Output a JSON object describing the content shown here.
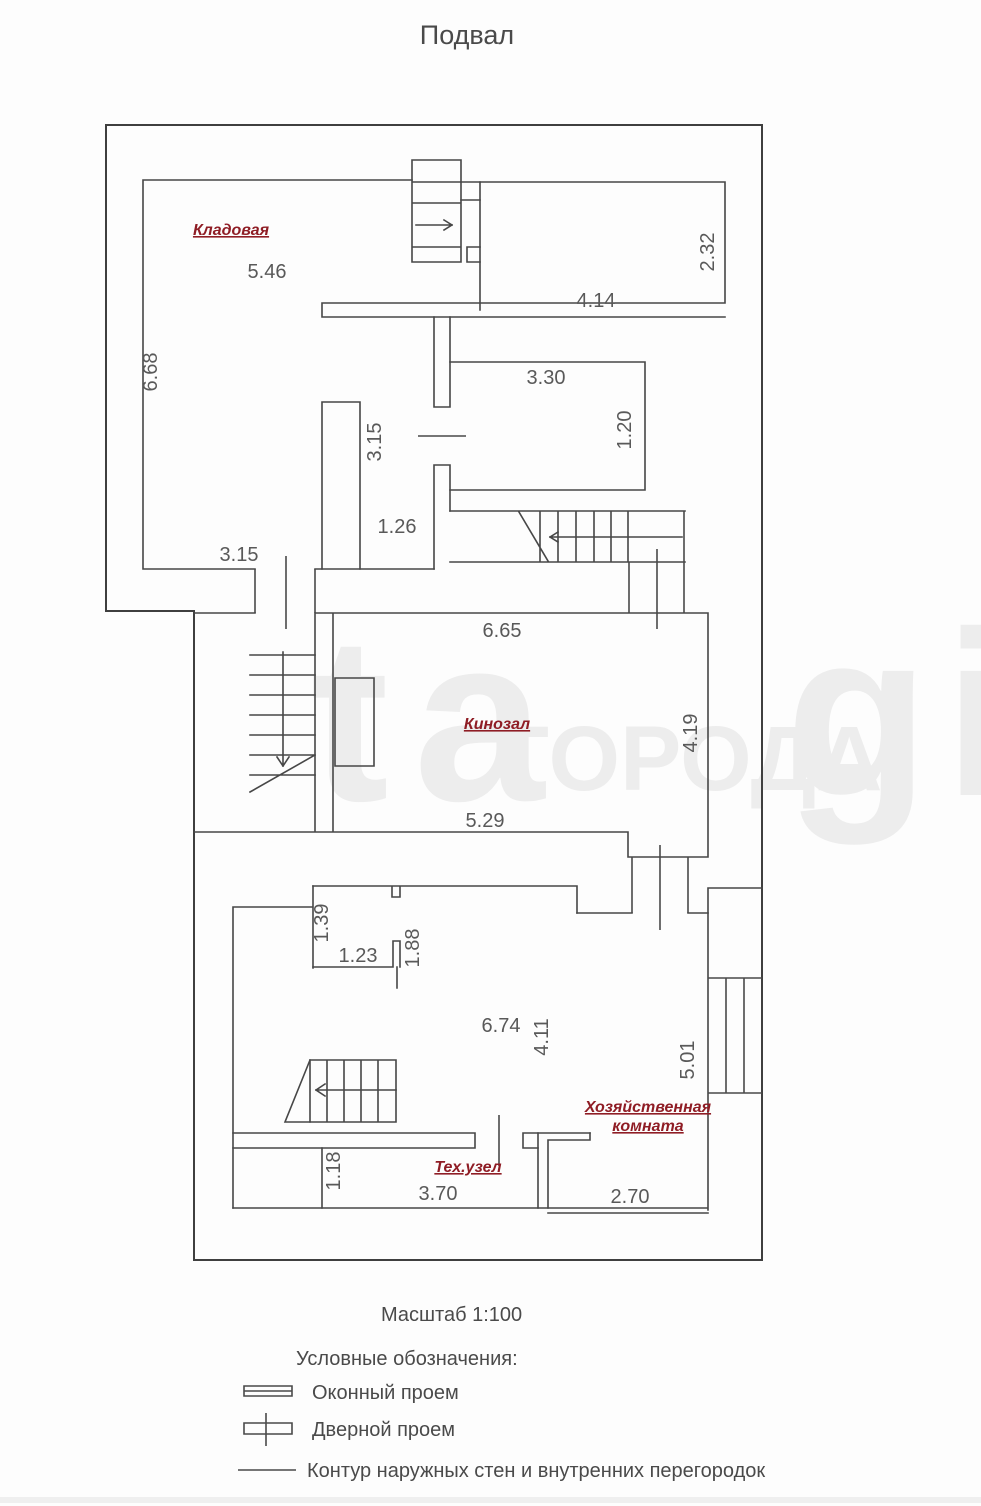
{
  "title": "Подвал",
  "scale_note": "Масштаб 1:100",
  "rooms": {
    "kladovaya": "Кладовая",
    "kinozal": "Кинозал",
    "hoz_line1": "Хозяйственная",
    "hoz_line2": "комната",
    "tehuzel": "Тех.узел"
  },
  "dims": {
    "d546": "5.46",
    "d668": "6.68",
    "d232": "2.32",
    "d414": "4.14",
    "d330": "3.30",
    "d120": "1.20",
    "d315a": "3.15",
    "d126": "1.26",
    "d315b": "3.15",
    "d665": "6.65",
    "d419": "4.19",
    "d529": "5.29",
    "d139": "1.39",
    "d123": "1.23",
    "d188": "1.88",
    "d674": "6.74",
    "d411": "4.11",
    "d501": "5.01",
    "d118": "1.18",
    "d370": "3.70",
    "d270": "2.70"
  },
  "legend": {
    "heading": "Условные обозначения:",
    "items": [
      {
        "label": "Оконный проем"
      },
      {
        "label": "Дверной проем"
      },
      {
        "label": "Контур наружных стен и внутренних перегородок"
      }
    ]
  },
  "watermark": {
    "brand_left": "ta",
    "city": "ГОРОДА",
    "brand_right": "gi"
  },
  "colors": {
    "wall": "#474747",
    "dim_text": "#595959",
    "room_label": "#8f1d25",
    "watermark": "#ececec"
  }
}
